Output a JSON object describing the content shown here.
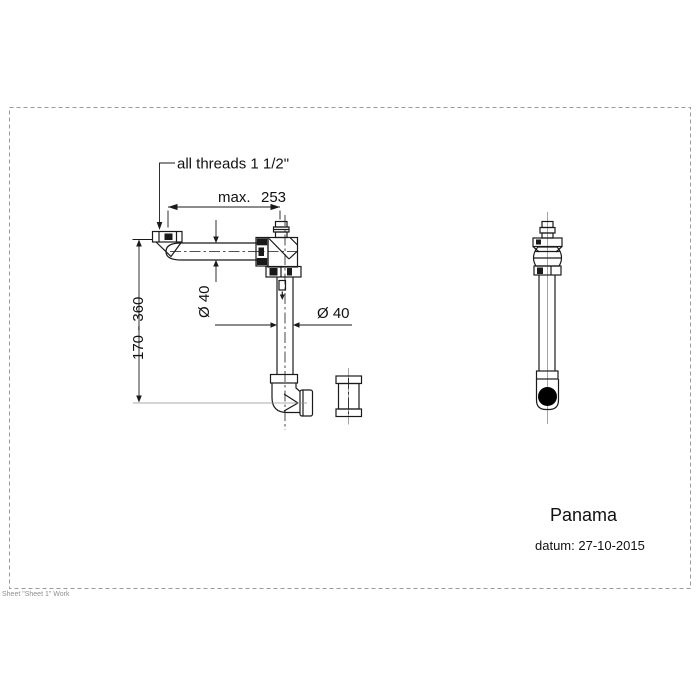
{
  "colors": {
    "line-color": "#1a1a1a",
    "centerline-color": "#8f8f8f",
    "border-color": "#9a9a9a",
    "text-color": "#111111"
  },
  "annotations": {
    "thread_callout": "all threads 1 1/2\"",
    "max_width_prefix": "max.",
    "max_width_value": "253",
    "height_range": "170 - 360",
    "vertical_pipe_diameter": "Ø 40",
    "horizontal_pipe_diameter": "Ø 40"
  },
  "title_block": {
    "product_name": "Panama",
    "date_line": "datum: 27-10-2015"
  },
  "footer": {
    "sheet_note": "Sheet \"Sheet 1\" Work"
  }
}
